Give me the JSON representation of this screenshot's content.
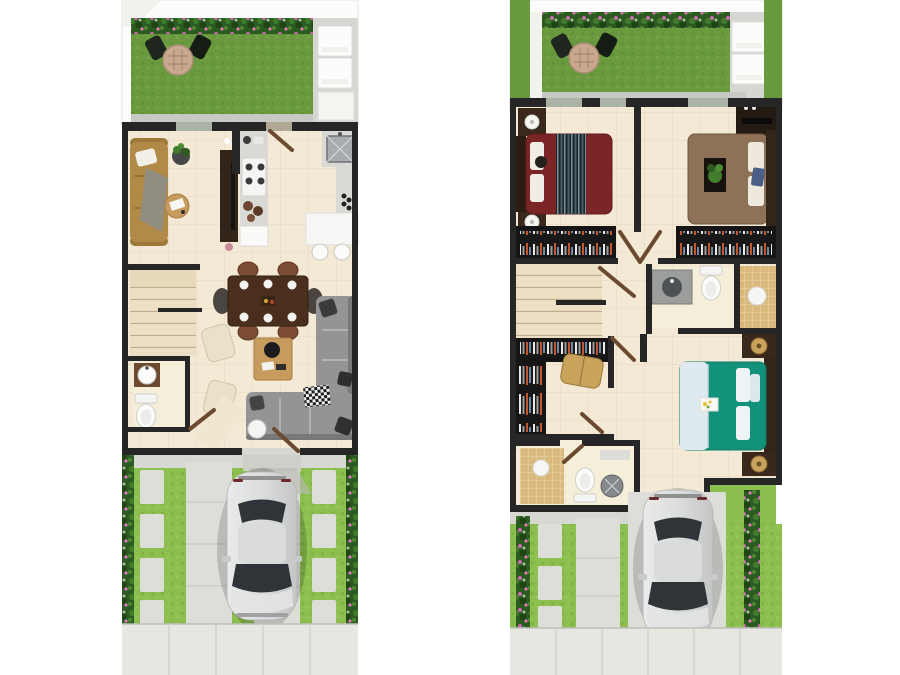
{
  "labels": {
    "page": "two-storey-house-floor-plans",
    "ground": "ground-floor-plan",
    "upper": "upper-floor-plan"
  },
  "semantics": {
    "ground_floor_rooms": [
      "backyard-garden",
      "laundry-patio",
      "living-room",
      "kitchen",
      "dining-area",
      "stairs",
      "powder-room",
      "family-area",
      "entry",
      "driveway",
      "sidewalk"
    ],
    "upper_floor_rooms": [
      "backyard-garden",
      "bedroom-1",
      "bedroom-2",
      "closets",
      "hallway",
      "stairs",
      "shared-bathroom",
      "walk-in-closet",
      "master-bedroom",
      "master-bathroom",
      "driveway",
      "sidewalk"
    ],
    "objects": [
      "bistro-set",
      "flower-hedge",
      "silver-car",
      "sofa",
      "tv-console",
      "stove",
      "kitchen-sink",
      "kitchen-island",
      "bar-stools",
      "dining-table",
      "toilet",
      "wash-basin",
      "sectional-sofa",
      "coffee-table",
      "accent-chairs",
      "beds",
      "nightstands",
      "lamps",
      "shower",
      "bench"
    ]
  },
  "colors": {
    "pageBg": "#ffffff",
    "wall": "#262626",
    "floor": "#f3e9d5",
    "floorLight": "#f5eed9",
    "grout": "#d8c9aa",
    "grassDark": "#6a9a3e",
    "grassLight": "#8cbf4e",
    "hedgeBase": "#2d5a21",
    "hedgeFlower": "#c76aae",
    "concrete": "#d6d6d2",
    "apron": "#d8d8d3",
    "paver": "#deded9",
    "sidewalk": "#e7e7e2",
    "pureWhite": "#fcfcfc",
    "softEdge": "#e3e3e0",
    "counter": "#d9d9d6",
    "cream": "#eae1ca",
    "sofaMustard": "#b08a46",
    "sectional": "#949494",
    "woodDark": "#33241a",
    "woodMid": "#6b4a30",
    "woodLight": "#c79a5e",
    "bedMaroon": "#7c2527",
    "bedBrown": "#8d7258",
    "bedTeal": "#12927a",
    "blanket": "#dfeaf0",
    "tanTile": "#d9b97e",
    "windowGlass": "#aab3a4",
    "carBodyLight": "#ebebeb",
    "carBodyDark": "#c7c8c9",
    "carGlass": "#2f3438",
    "stairBase": "#ecdfc4",
    "stairLine": "#bfae8e",
    "benchGold": "#c9a35c"
  }
}
